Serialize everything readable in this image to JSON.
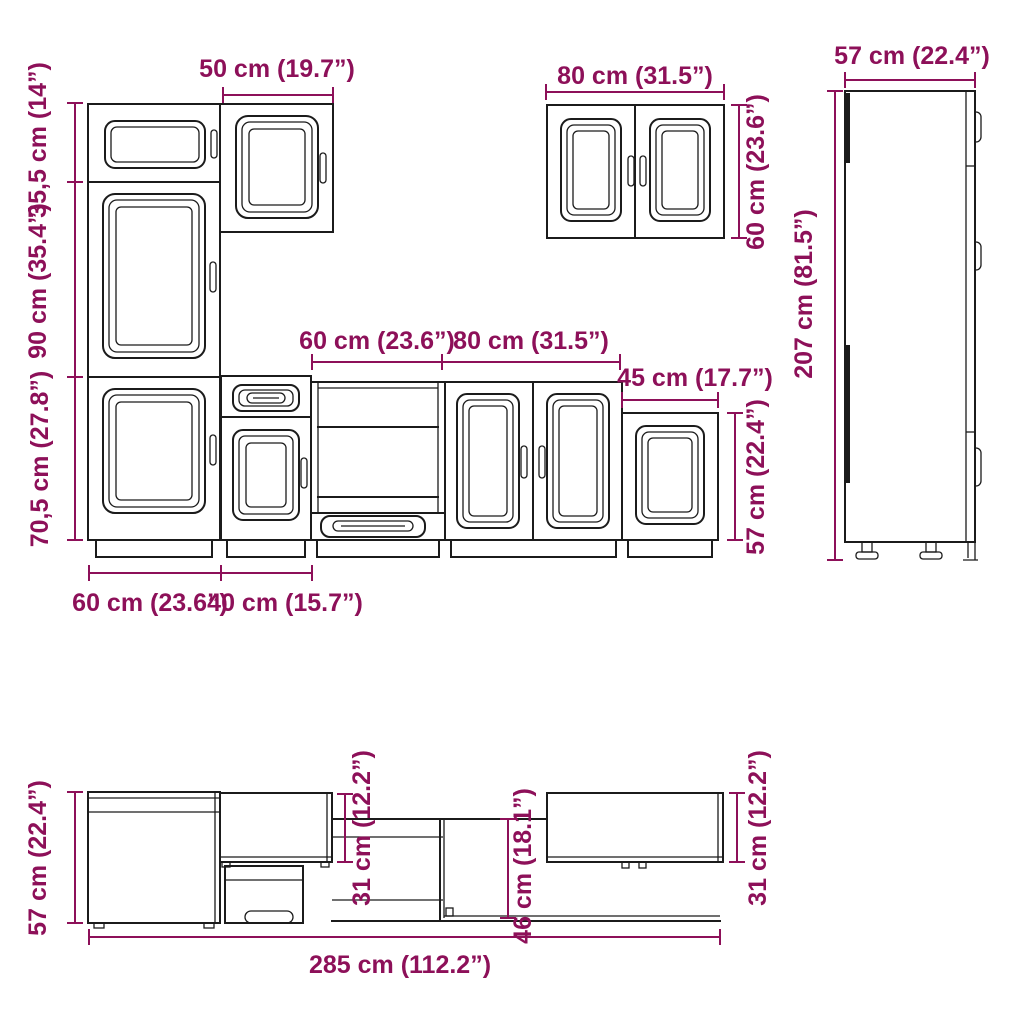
{
  "diagram": {
    "type": "furniture-dimension-diagram",
    "accent_color": "#8d1059",
    "line_color": "#1b1b1b",
    "views": {
      "front_left": {
        "upper_height": "35,5 cm (14”)",
        "middle_height": "90 cm (35.4”)",
        "lower_height": "70,5 cm (27.8”)",
        "top_width": "50 cm (19.7”)",
        "bottom_left_width": "60 cm (23.6”)",
        "bottom_right_width": "40 cm (15.7”)"
      },
      "base_run": {
        "oven_width": "60 cm (23.6”)",
        "sink_width": "80 cm (31.5”)",
        "end_width": "45 cm (17.7”)",
        "height": "57 cm (22.4”)"
      },
      "wall_cabinet": {
        "width": "80 cm (31.5”)",
        "height": "60 cm (23.6”)"
      },
      "side_view": {
        "depth": "57 cm (22.4”)",
        "height": "207 cm (81.5”)"
      },
      "plan_view": {
        "left_depth": "57 cm (22.4”)",
        "mid_wall_depth": "31 cm (12.2”)",
        "counter_depth": "46 cm (18.1”)",
        "right_wall_depth": "31 cm (12.2”)",
        "total_width": "285 cm (112.2”)"
      }
    }
  }
}
